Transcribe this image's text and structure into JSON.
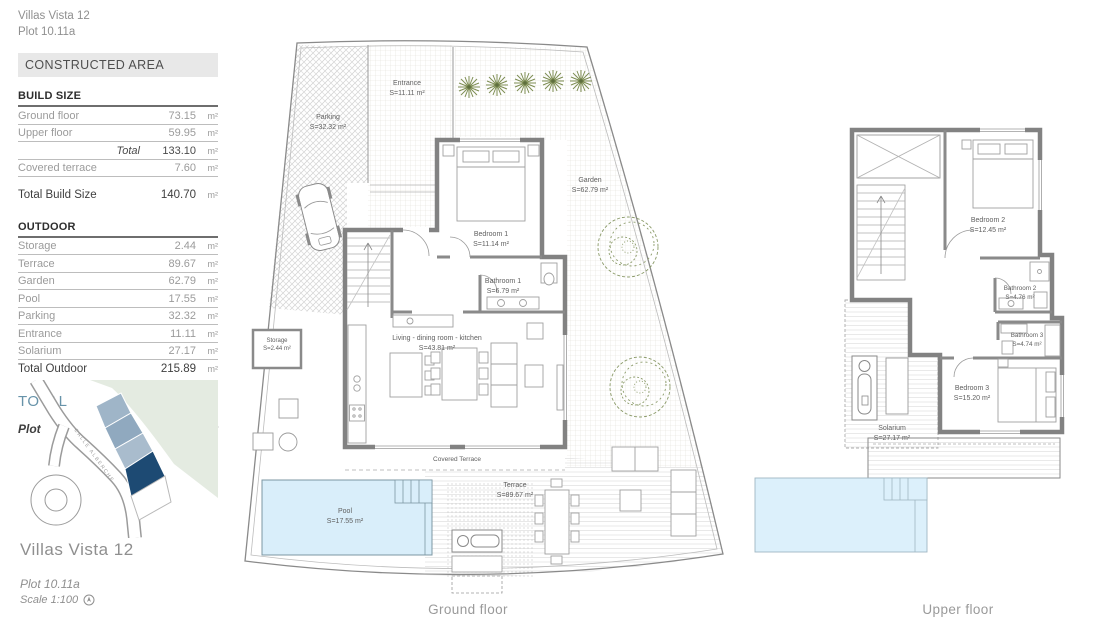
{
  "header": {
    "line1": "Villas Vista 12",
    "line2": "Plot 10.11a"
  },
  "panel": {
    "constructed_area_header": "CONSTRUCTED AREA",
    "build_size": {
      "heading": "BUILD SIZE",
      "rows": [
        {
          "label": "Ground floor",
          "value": "73.15",
          "unit": "m²"
        },
        {
          "label": "Upper floor",
          "value": "59.95",
          "unit": "m²"
        }
      ],
      "total_row": {
        "label": "Total",
        "value": "133.10",
        "unit": "m²"
      },
      "covered_terrace_row": {
        "label": "Covered terrace",
        "value": "7.60",
        "unit": "m²"
      },
      "total_build_row": {
        "label": "Total Build Size",
        "value": "140.70",
        "unit": "m²"
      }
    },
    "outdoor": {
      "heading": "OUTDOOR",
      "rows": [
        {
          "label": "Storage",
          "value": "2.44",
          "unit": "m²"
        },
        {
          "label": "Terrace",
          "value": "89.67",
          "unit": "m²"
        },
        {
          "label": "Garden",
          "value": "62.79",
          "unit": "m²"
        },
        {
          "label": "Pool",
          "value": "17.55",
          "unit": "m²"
        },
        {
          "label": "Parking",
          "value": "32.32",
          "unit": "m²"
        },
        {
          "label": "Entrance",
          "value": "11.11",
          "unit": "m²"
        },
        {
          "label": "Solarium",
          "value": "27.17",
          "unit": "m²"
        }
      ],
      "total_row": {
        "label": "Total Outdoor",
        "value": "215.89",
        "unit": "m²"
      }
    },
    "grand_total": {
      "label": "TOTAL",
      "value": "356.59",
      "unit": "m²"
    },
    "plot": {
      "label": "Plot",
      "value": "300,00",
      "unit": "m²"
    }
  },
  "site_map": {
    "street_label": "CALLE ALBERCHE",
    "brand": "Villas Vista 12",
    "plot_label": "Plot 10.11a",
    "scale_label": "Scale 1:100"
  },
  "ground_floor": {
    "caption": "Ground floor",
    "rooms": {
      "parking": {
        "name": "Parking",
        "area": "S=32.32 m²"
      },
      "entrance": {
        "name": "Entrance",
        "area": "S=11.11 m²"
      },
      "garden": {
        "name": "Garden",
        "area": "S=62.79 m²"
      },
      "bedroom1": {
        "name": "Bedroom 1",
        "area": "S=11.14 m²"
      },
      "bathroom1": {
        "name": "Bathroom 1",
        "area": "S=6.79 m²"
      },
      "living": {
        "name": "Living - dining  room - kitchen",
        "area": "S=43.81 m²"
      },
      "storage": {
        "name": "Storage",
        "area": "S=2.44 m²"
      },
      "covered_terrace": {
        "name": "Covered Terrace"
      },
      "pool": {
        "name": "Pool",
        "area": "S=17.55 m²"
      },
      "terrace": {
        "name": "Terrace",
        "area": "S=89.67 m²"
      }
    }
  },
  "upper_floor": {
    "caption": "Upper floor",
    "rooms": {
      "bedroom2": {
        "name": "Bedroom 2",
        "area": "S=12.45 m²"
      },
      "bathroom2": {
        "name": "Bathroom 2",
        "area": "S=4.76 m²"
      },
      "bathroom3": {
        "name": "Bathroom 3",
        "area": "S=4.74 m²"
      },
      "bedroom3": {
        "name": "Bedroom 3",
        "area": "S=15.20 m²"
      },
      "solarium": {
        "name": "Solarium",
        "area": "S=27.17 m²"
      }
    }
  },
  "colors": {
    "accent_total": "#6793a9",
    "pool_fill": "#d9eefa",
    "plot_highlight": "#1d4a73",
    "plot_light": "#9fb5c8",
    "map_green": "#e4ebe1",
    "wall_gray": "#828282",
    "tree_green": "#7d8d52"
  }
}
